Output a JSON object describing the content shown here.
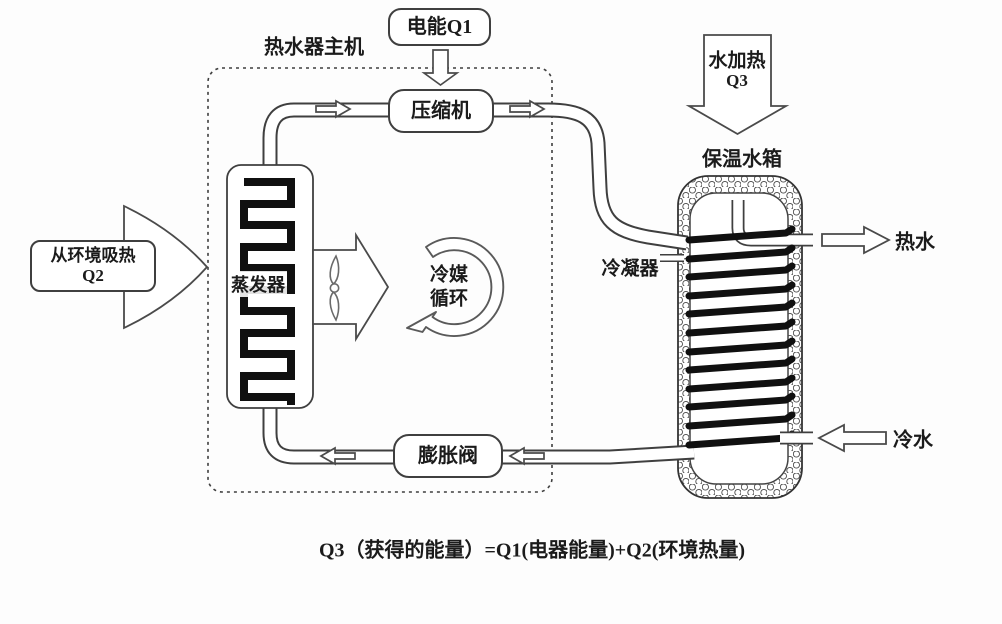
{
  "colors": {
    "background": "#fdfdfd",
    "line": "#3f3f3f",
    "coil": "#101010",
    "text": "#1b1b1b"
  },
  "diagram": {
    "labels": {
      "electric_energy": "电能Q1",
      "main_unit": "热水器主机",
      "compressor": "压缩机",
      "evaporator": "蒸发器",
      "refrigerant_line1": "冷媒",
      "refrigerant_line2": "循环",
      "env_heat_line1": "从环境吸热",
      "env_heat_line2": "Q2",
      "water_heating_line1": "水加热",
      "water_heating_line2": "Q3",
      "tank": "保温水箱",
      "condenser": "冷凝器",
      "hot_water": "热水",
      "cold_water": "冷水",
      "expansion_valve": "膨胀阀",
      "formula": "Q3（获得的能量）=Q1(电器能量)+Q2(环境热量)"
    }
  }
}
